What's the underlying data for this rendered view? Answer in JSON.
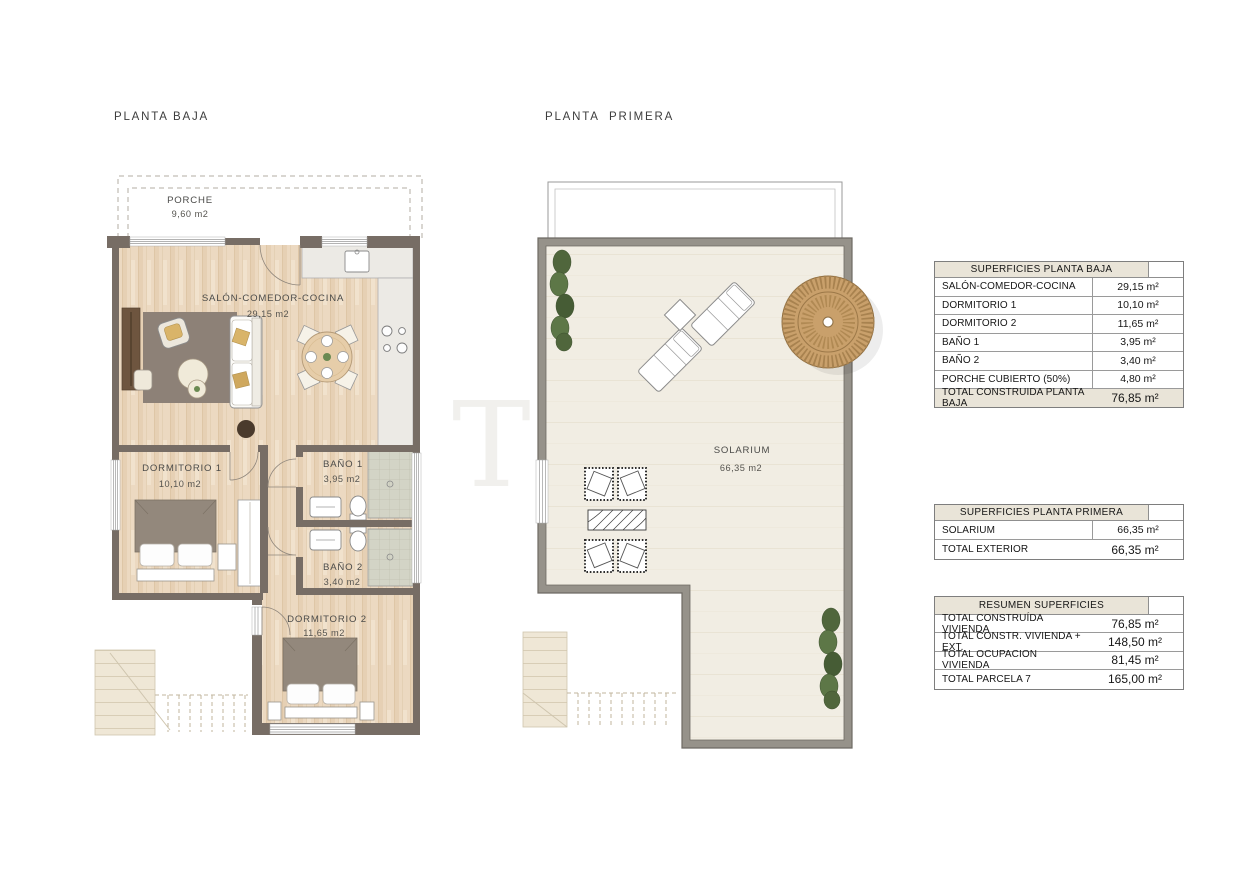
{
  "page": {
    "watermark": "T",
    "background": "#ffffff"
  },
  "colors": {
    "wall_ground_floor": "#776d65",
    "wall_first_floor": "#96928a",
    "wood_floor": "#ecd9c1",
    "solarium_floor": "#f1ede3",
    "rug": "#8d8177",
    "table_header_bg": "#e9e4d8",
    "parasol": "#c9a06b",
    "plant_green": "#55713f",
    "shower_tile": "#d3d4c6"
  },
  "planta_baja": {
    "title": "PLANTA BAJA",
    "rooms": {
      "porche": {
        "name": "PORCHE",
        "area": "9,60 m2"
      },
      "salon": {
        "name": "SALÓN-COMEDOR-COCINA",
        "area": "29,15 m2"
      },
      "dormitorio1": {
        "name": "DORMITORIO 1",
        "area": "10,10 m2"
      },
      "bano1": {
        "name": "BAÑO 1",
        "area": "3,95 m2"
      },
      "bano2": {
        "name": "BAÑO 2",
        "area": "3,40 m2"
      },
      "dormitorio2": {
        "name": "DORMITORIO 2",
        "area": "11,65 m2"
      }
    }
  },
  "planta_primera": {
    "title": "PLANTA PRIMERA",
    "rooms": {
      "solarium": {
        "name": "SOLARIUM",
        "area": "66,35 m2"
      }
    }
  },
  "tables": [
    {
      "header": "SUPERFICIES PLANTA BAJA",
      "rows": [
        {
          "label": "SALÓN-COMEDOR-COCINA",
          "value": "29,15 m²"
        },
        {
          "label": "DORMITORIO 1",
          "value": "10,10 m²"
        },
        {
          "label": "DORMITORIO 2",
          "value": "11,65 m²"
        },
        {
          "label": "BAÑO 1",
          "value": "3,95 m²"
        },
        {
          "label": "BAÑO 2",
          "value": "3,40 m²"
        },
        {
          "label": "PORCHE CUBIERTO (50%)",
          "value": "4,80 m²"
        }
      ],
      "total": {
        "label": "TOTAL CONSTRUIDA PLANTA BAJA",
        "value": "76,85 m²"
      }
    },
    {
      "header": "SUPERFICIES PLANTA PRIMERA",
      "rows": [
        {
          "label": "SOLARIUM",
          "value": "66,35 m²"
        }
      ],
      "total": {
        "label": "TOTAL EXTERIOR",
        "value": "66,35 m²"
      }
    },
    {
      "header": "RESUMEN SUPERFICIES",
      "rows": [
        {
          "label": "TOTAL CONSTRUÍDA VIVIENDA",
          "value": "76,85 m²"
        },
        {
          "label": "TOTAL CONSTR. VIVIENDA + EXT.",
          "value": "148,50 m²"
        },
        {
          "label": "TOTAL OCUPACION VIVIENDA",
          "value": "81,45 m²"
        },
        {
          "label": "TOTAL PARCELA 7",
          "value": "165,00 m²"
        }
      ]
    }
  ]
}
